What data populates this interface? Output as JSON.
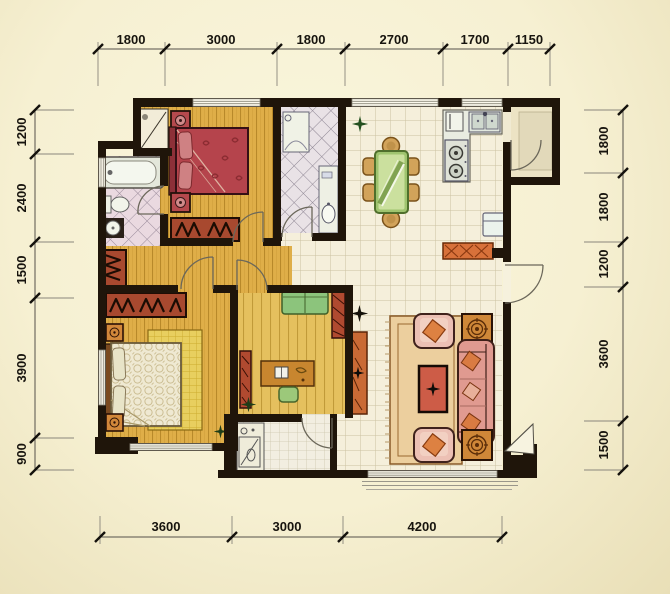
{
  "title": "apartment-floor-plan",
  "dimensions": {
    "top": [
      "1800",
      "3000",
      "1800",
      "2700",
      "1700",
      "1150"
    ],
    "bottom": [
      "3600",
      "3000",
      "4200"
    ],
    "left": [
      "1200",
      "2400",
      "1500",
      "3900",
      "900"
    ],
    "right": [
      "1800",
      "1800",
      "1200",
      "3600",
      "1500"
    ]
  },
  "colors": {
    "background": "#f6f0d2",
    "wall": "#1f150a",
    "wood_floor": "#dfae48",
    "study_floor": "#e5c05e",
    "tile_floor": "#f5efdb",
    "bath_tile": "#ead9e0",
    "accent_red": "#b5444c",
    "accent_rust": "#b04a30",
    "accent_orange": "#d2863a",
    "accent_green": "#9cc87a",
    "sofa_pink": "#e09a90",
    "rug_tan": "#eccf9e"
  },
  "icons": {
    "plant": "star-burst",
    "door": "quarter-arc-swing",
    "stove": "twin-burner-circles",
    "sink": "twin-basin-rects",
    "dimension-tick": "diagonal-slash"
  }
}
